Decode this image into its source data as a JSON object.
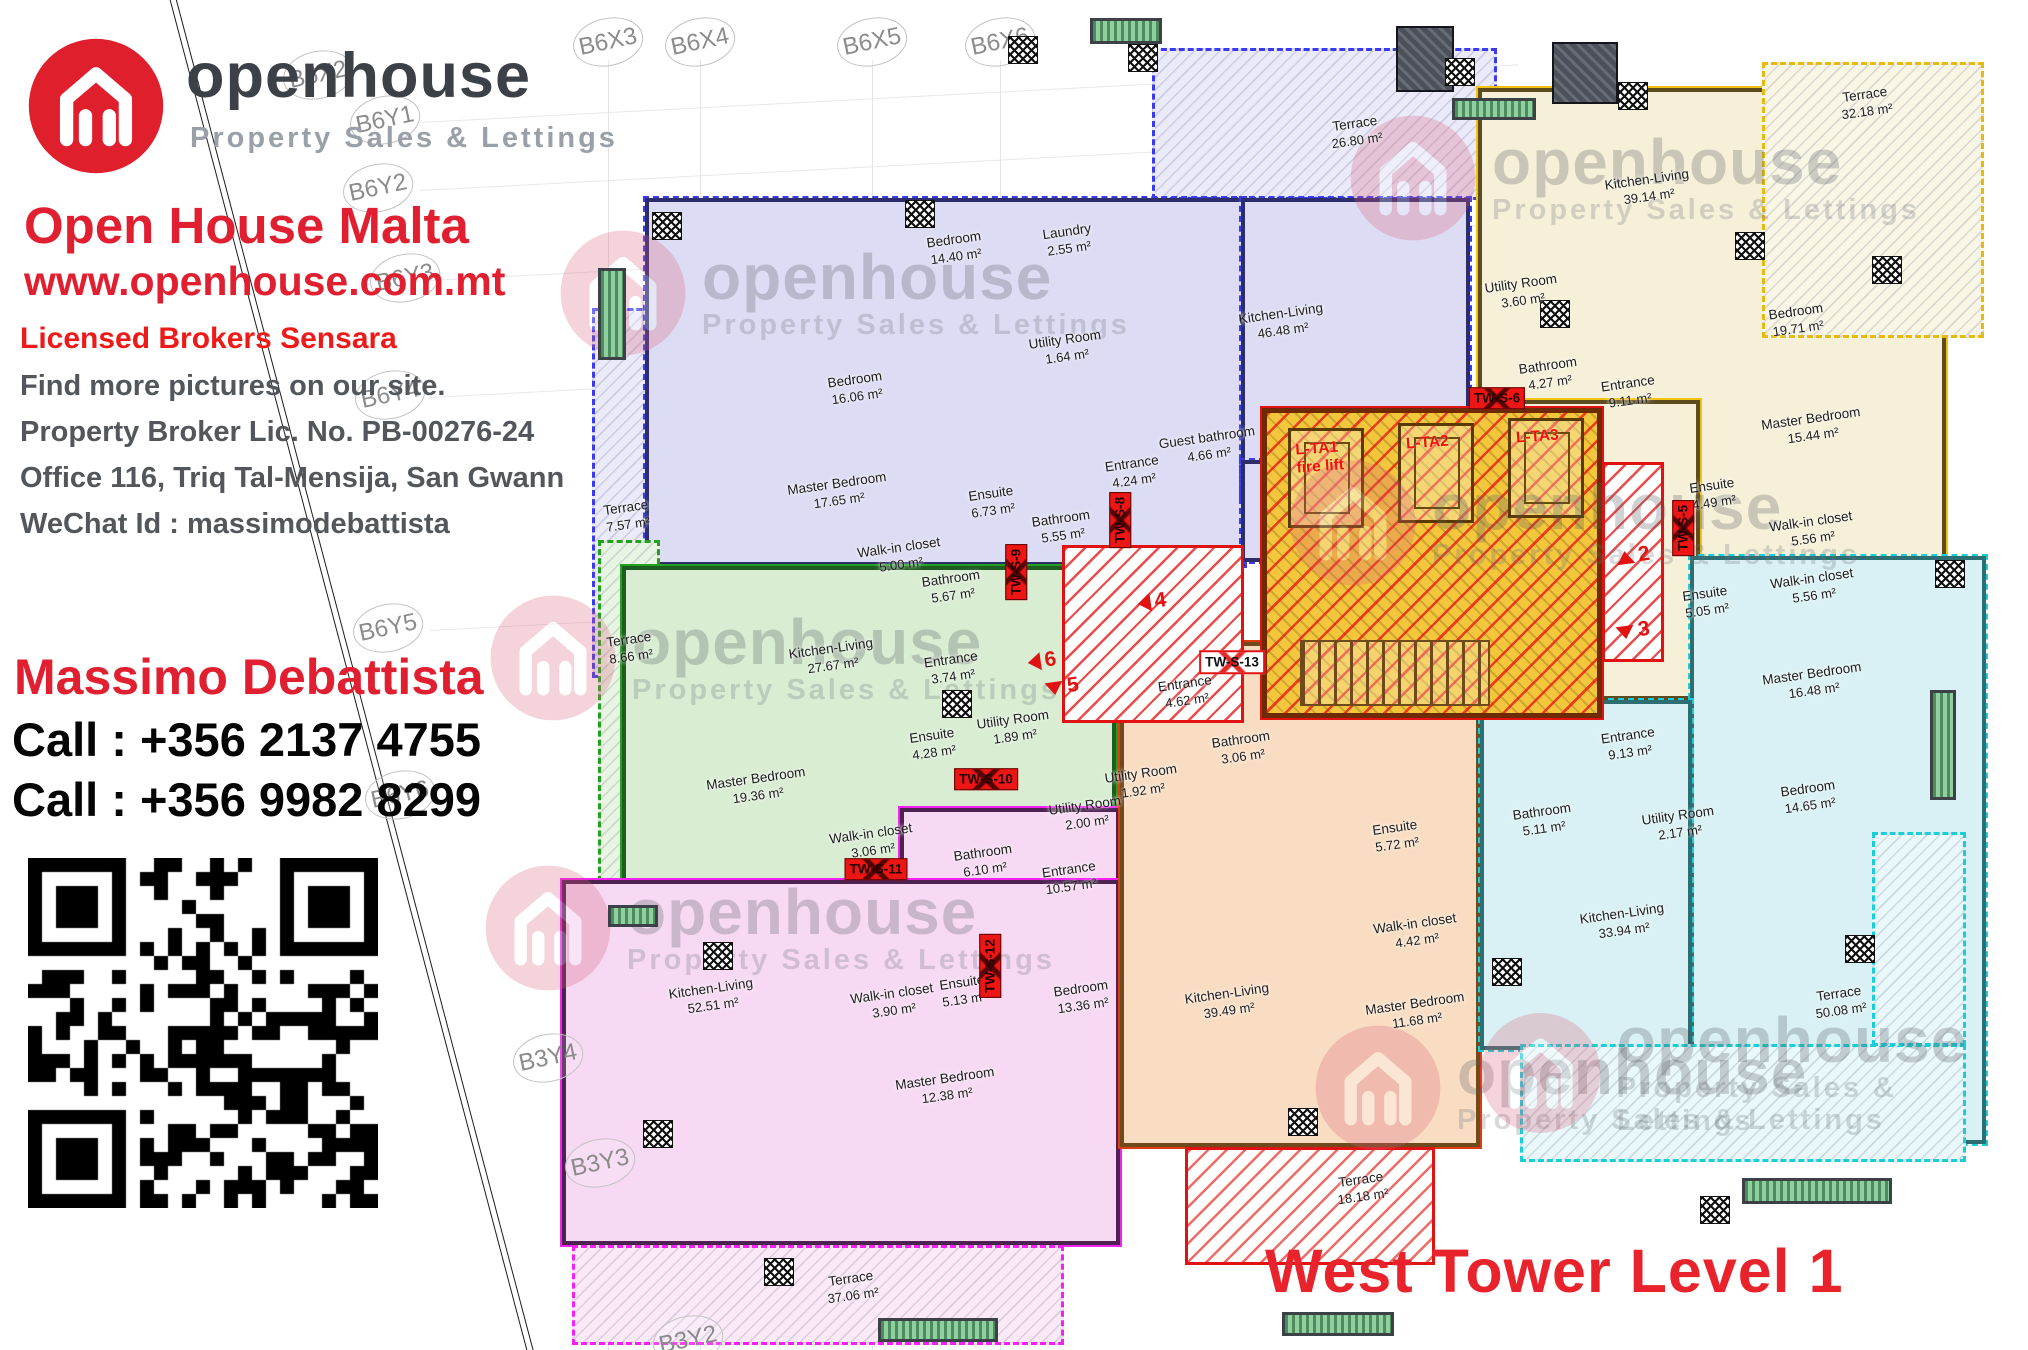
{
  "branding": {
    "wordmark": "openhouse",
    "tagline": "Property Sales & Lettings",
    "agency_title": "Open House Malta",
    "website": "www.openhouse.com.mt",
    "license_line": "Licensed Brokers Sensara",
    "note": "Find more pictures on our site.",
    "broker_license": "Property Broker Lic. No. PB-00276-24",
    "office_address": "Office 116, Triq Tal-Mensija, San Gwann",
    "wechat": "WeChat Id : massimodebattista",
    "agent_name": "Massimo Debattista",
    "phone1": "Call : +356 2137 4755",
    "phone2": "Call : +356 9982 8299"
  },
  "plan_title": "West Tower Level 1",
  "colors": {
    "brand_red": "#e02030",
    "purple_fill": "#dcdcf4",
    "green_fill": "#d8edd2",
    "pink_fill": "#f7d9f3",
    "orange_fill": "#f9ddc2",
    "cream_fill": "#f6f0d8",
    "cyan_fill": "#d9f1f4",
    "core_yellow": "#f3c63c",
    "tag_red": "#ee1515"
  },
  "grid_labels": [
    {
      "label": "B6X2",
      "x": 318,
      "y": 75
    },
    {
      "label": "B6X3",
      "x": 608,
      "y": 42
    },
    {
      "label": "B6X4",
      "x": 700,
      "y": 42
    },
    {
      "label": "B6X5",
      "x": 872,
      "y": 42
    },
    {
      "label": "B6X6",
      "x": 1000,
      "y": 42
    },
    {
      "label": "B6Y1",
      "x": 385,
      "y": 120
    },
    {
      "label": "B6Y2",
      "x": 378,
      "y": 188
    },
    {
      "label": "B6Y3",
      "x": 405,
      "y": 278
    },
    {
      "label": "B6Y4",
      "x": 390,
      "y": 395
    },
    {
      "label": "B6Y5",
      "x": 388,
      "y": 628
    },
    {
      "label": "B6Y6",
      "x": 400,
      "y": 795
    },
    {
      "label": "B3Y4",
      "x": 548,
      "y": 1058
    },
    {
      "label": "B3Y3",
      "x": 600,
      "y": 1163
    },
    {
      "label": "B3Y2",
      "x": 688,
      "y": 1340
    }
  ],
  "apartments": [
    {
      "id": "purple",
      "rooms": [
        {
          "label": "Bedroom",
          "area": "14.40 m²",
          "x": 955,
          "y": 248
        },
        {
          "label": "Laundry",
          "area": "2.55 m²",
          "x": 1068,
          "y": 240
        },
        {
          "label": "Utility Room",
          "area": "1.64 m²",
          "x": 1066,
          "y": 348
        },
        {
          "label": "Kitchen-Living",
          "area": "46.48 m²",
          "x": 1282,
          "y": 322
        },
        {
          "label": "Bedroom",
          "area": "16.06 m²",
          "x": 856,
          "y": 388
        },
        {
          "label": "Master Bedroom",
          "area": "17.65 m²",
          "x": 838,
          "y": 492
        },
        {
          "label": "Walk-in closet",
          "area": "5.00 m²",
          "x": 900,
          "y": 556
        },
        {
          "label": "Ensuite",
          "area": "6.73 m²",
          "x": 992,
          "y": 502
        },
        {
          "label": "Bathroom",
          "area": "5.55 m²",
          "x": 1062,
          "y": 527
        },
        {
          "label": "Entrance",
          "area": "4.24 m²",
          "x": 1133,
          "y": 472
        },
        {
          "label": "Guest bathroom",
          "area": "4.66 m²",
          "x": 1208,
          "y": 446
        },
        {
          "label": "Terrace",
          "area": "7.57 m²",
          "x": 627,
          "y": 516
        },
        {
          "label": "Terrace",
          "area": "26.80 m²",
          "x": 1356,
          "y": 132
        }
      ]
    },
    {
      "id": "green",
      "rooms": [
        {
          "label": "Bathroom",
          "area": "5.67 m²",
          "x": 952,
          "y": 587
        },
        {
          "label": "Kitchen-Living",
          "area": "27.67 m²",
          "x": 832,
          "y": 657
        },
        {
          "label": "Entrance",
          "area": "3.74 m²",
          "x": 952,
          "y": 668
        },
        {
          "label": "Ensuite",
          "area": "4.28 m²",
          "x": 933,
          "y": 744
        },
        {
          "label": "Utility Room",
          "area": "1.89 m²",
          "x": 1014,
          "y": 728
        },
        {
          "label": "Master Bedroom",
          "area": "19.36 m²",
          "x": 757,
          "y": 787
        },
        {
          "label": "Walk-in closet",
          "area": "3.06 m²",
          "x": 872,
          "y": 842
        },
        {
          "label": "Terrace",
          "area": "8.66 m²",
          "x": 630,
          "y": 648
        }
      ]
    },
    {
      "id": "pink",
      "rooms": [
        {
          "label": "Utility Room",
          "area": "2.00 m²",
          "x": 1086,
          "y": 814
        },
        {
          "label": "Bathroom",
          "area": "6.10 m²",
          "x": 984,
          "y": 861
        },
        {
          "label": "Entrance",
          "area": "10.57 m²",
          "x": 1070,
          "y": 878
        },
        {
          "label": "Kitchen-Living",
          "area": "52.51 m²",
          "x": 712,
          "y": 997
        },
        {
          "label": "Walk-in closet",
          "area": "3.90 m²",
          "x": 893,
          "y": 1002
        },
        {
          "label": "Ensuite",
          "area": "5.13 m²",
          "x": 963,
          "y": 991
        },
        {
          "label": "Bedroom",
          "area": "13.36 m²",
          "x": 1082,
          "y": 997
        },
        {
          "label": "Master Bedroom",
          "area": "12.38 m²",
          "x": 946,
          "y": 1087
        },
        {
          "label": "Terrace",
          "area": "37.06 m²",
          "x": 852,
          "y": 1287
        }
      ]
    },
    {
      "id": "orange",
      "rooms": [
        {
          "label": "Entrance",
          "area": "4.62 m²",
          "x": 1186,
          "y": 692
        },
        {
          "label": "Utility Room",
          "area": "1.92 m²",
          "x": 1142,
          "y": 782
        },
        {
          "label": "Bathroom",
          "area": "3.06 m²",
          "x": 1242,
          "y": 748
        },
        {
          "label": "Ensuite",
          "area": "5.72 m²",
          "x": 1396,
          "y": 836
        },
        {
          "label": "Walk-in closet",
          "area": "4.42 m²",
          "x": 1416,
          "y": 932
        },
        {
          "label": "Master Bedroom",
          "area": "11.68 m²",
          "x": 1416,
          "y": 1012
        },
        {
          "label": "Kitchen-Living",
          "area": "39.49 m²",
          "x": 1228,
          "y": 1002
        },
        {
          "label": "Terrace",
          "area": "18.18 m²",
          "x": 1362,
          "y": 1188
        }
      ]
    },
    {
      "id": "cream",
      "rooms": [
        {
          "label": "Terrace",
          "area": "32.18 m²",
          "x": 1866,
          "y": 103
        },
        {
          "label": "Kitchen-Living",
          "area": "39.14 m²",
          "x": 1648,
          "y": 188
        },
        {
          "label": "Utility Room",
          "area": "3.60 m²",
          "x": 1522,
          "y": 292
        },
        {
          "label": "Bathroom",
          "area": "4.27 m²",
          "x": 1549,
          "y": 374
        },
        {
          "label": "Entrance",
          "area": "9.11 m²",
          "x": 1629,
          "y": 392
        },
        {
          "label": "Bedroom",
          "area": "19.71 m²",
          "x": 1797,
          "y": 320
        },
        {
          "label": "Master Bedroom",
          "area": "15.44 m²",
          "x": 1812,
          "y": 427
        },
        {
          "label": "Ensuite",
          "area": "4.49 m²",
          "x": 1713,
          "y": 494
        },
        {
          "label": "Walk-in closet",
          "area": "5.56 m²",
          "x": 1812,
          "y": 530
        }
      ]
    },
    {
      "id": "cyan",
      "rooms": [
        {
          "label": "Ensuite",
          "area": "5.05 m²",
          "x": 1706,
          "y": 602
        },
        {
          "label": "Walk-in closet",
          "area": "5.56 m²",
          "x": 1813,
          "y": 587
        },
        {
          "label": "Master Bedroom",
          "area": "16.48 m²",
          "x": 1813,
          "y": 682
        },
        {
          "label": "Entrance",
          "area": "9.13 m²",
          "x": 1629,
          "y": 744
        },
        {
          "label": "Bathroom",
          "area": "5.11 m²",
          "x": 1543,
          "y": 820
        },
        {
          "label": "Utility Room",
          "area": "2.17 m²",
          "x": 1679,
          "y": 824
        },
        {
          "label": "Bedroom",
          "area": "14.65 m²",
          "x": 1809,
          "y": 797
        },
        {
          "label": "Kitchen-Living",
          "area": "33.94 m²",
          "x": 1623,
          "y": 922
        },
        {
          "label": "Terrace",
          "area": "50.08 m²",
          "x": 1840,
          "y": 1002
        }
      ]
    }
  ],
  "core": {
    "lifts": [
      {
        "label": "L-TA1",
        "sub": "fire lift",
        "x": 1296,
        "y": 440
      },
      {
        "label": "L-TA2",
        "sub": "",
        "x": 1406,
        "y": 434
      },
      {
        "label": "L-TA3",
        "sub": "",
        "x": 1516,
        "y": 428
      }
    ]
  },
  "tags": [
    {
      "label": "TW-S-5",
      "x": 1683,
      "y": 528,
      "vertical": true,
      "variant": "red"
    },
    {
      "label": "TW-S-6",
      "x": 1497,
      "y": 398,
      "vertical": false,
      "variant": "red"
    },
    {
      "label": "TW-S-8",
      "x": 1120,
      "y": 520,
      "vertical": true,
      "variant": "red"
    },
    {
      "label": "TW-S-9",
      "x": 1016,
      "y": 572,
      "vertical": true,
      "variant": "red"
    },
    {
      "label": "TW-S-10",
      "x": 986,
      "y": 779,
      "vertical": false,
      "variant": "red"
    },
    {
      "label": "TW-S-11",
      "x": 876,
      "y": 869,
      "vertical": false,
      "variant": "red"
    },
    {
      "label": "TW-S-12",
      "x": 990,
      "y": 966,
      "vertical": true,
      "variant": "red"
    },
    {
      "label": "TW-S-13",
      "x": 1232,
      "y": 662,
      "vertical": false,
      "variant": "white"
    }
  ],
  "stair_numbers": [
    {
      "label": "4",
      "x": 1152,
      "y": 602,
      "dir": "left"
    },
    {
      "label": "6",
      "x": 1042,
      "y": 661,
      "dir": "left"
    },
    {
      "label": "5",
      "x": 1062,
      "y": 687,
      "dir": "down"
    },
    {
      "label": "2",
      "x": 1633,
      "y": 556,
      "dir": "up"
    },
    {
      "label": "3",
      "x": 1633,
      "y": 631,
      "dir": "down"
    }
  ],
  "watermarks": [
    {
      "x": 558,
      "y": 228
    },
    {
      "x": 1348,
      "y": 113
    },
    {
      "x": 488,
      "y": 593
    },
    {
      "x": 1288,
      "y": 458
    },
    {
      "x": 483,
      "y": 863
    },
    {
      "x": 1313,
      "y": 1023
    },
    {
      "x": 1478,
      "y": 1008
    }
  ]
}
